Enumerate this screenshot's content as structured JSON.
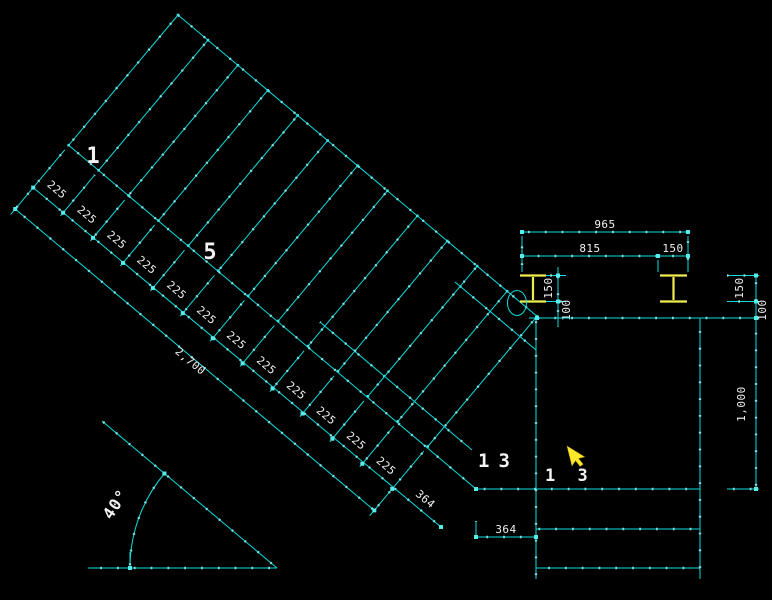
{
  "stair": {
    "segments": [
      "225",
      "225",
      "225",
      "225",
      "225",
      "225",
      "225",
      "225",
      "225",
      "225",
      "225",
      "225"
    ],
    "total_run_label": "2,700",
    "end_segment_label": "364",
    "angle_label": "40°",
    "tread_labels": {
      "first": "1",
      "middle": "5",
      "last": "13",
      "last_repeat": "1 3"
    }
  },
  "beam_dims": {
    "overall": "965",
    "left": "815",
    "right": "150"
  },
  "left_chain": {
    "top": "150",
    "bottom": "100"
  },
  "right_chain": {
    "top": "150",
    "middle": "100",
    "bottom": "1,000"
  },
  "landing": {
    "offset_label": "364"
  },
  "icons": {
    "cursor": "cad-pointer-cursor"
  },
  "colors": {
    "background": "#000000",
    "line": "#0edcdc",
    "line_dot": "#9df0f0",
    "grip": "#55ecec",
    "text": "#f2f2f2",
    "steel_yellow": "#f0ee4e",
    "cursor_yellow": "#ffe92a"
  }
}
